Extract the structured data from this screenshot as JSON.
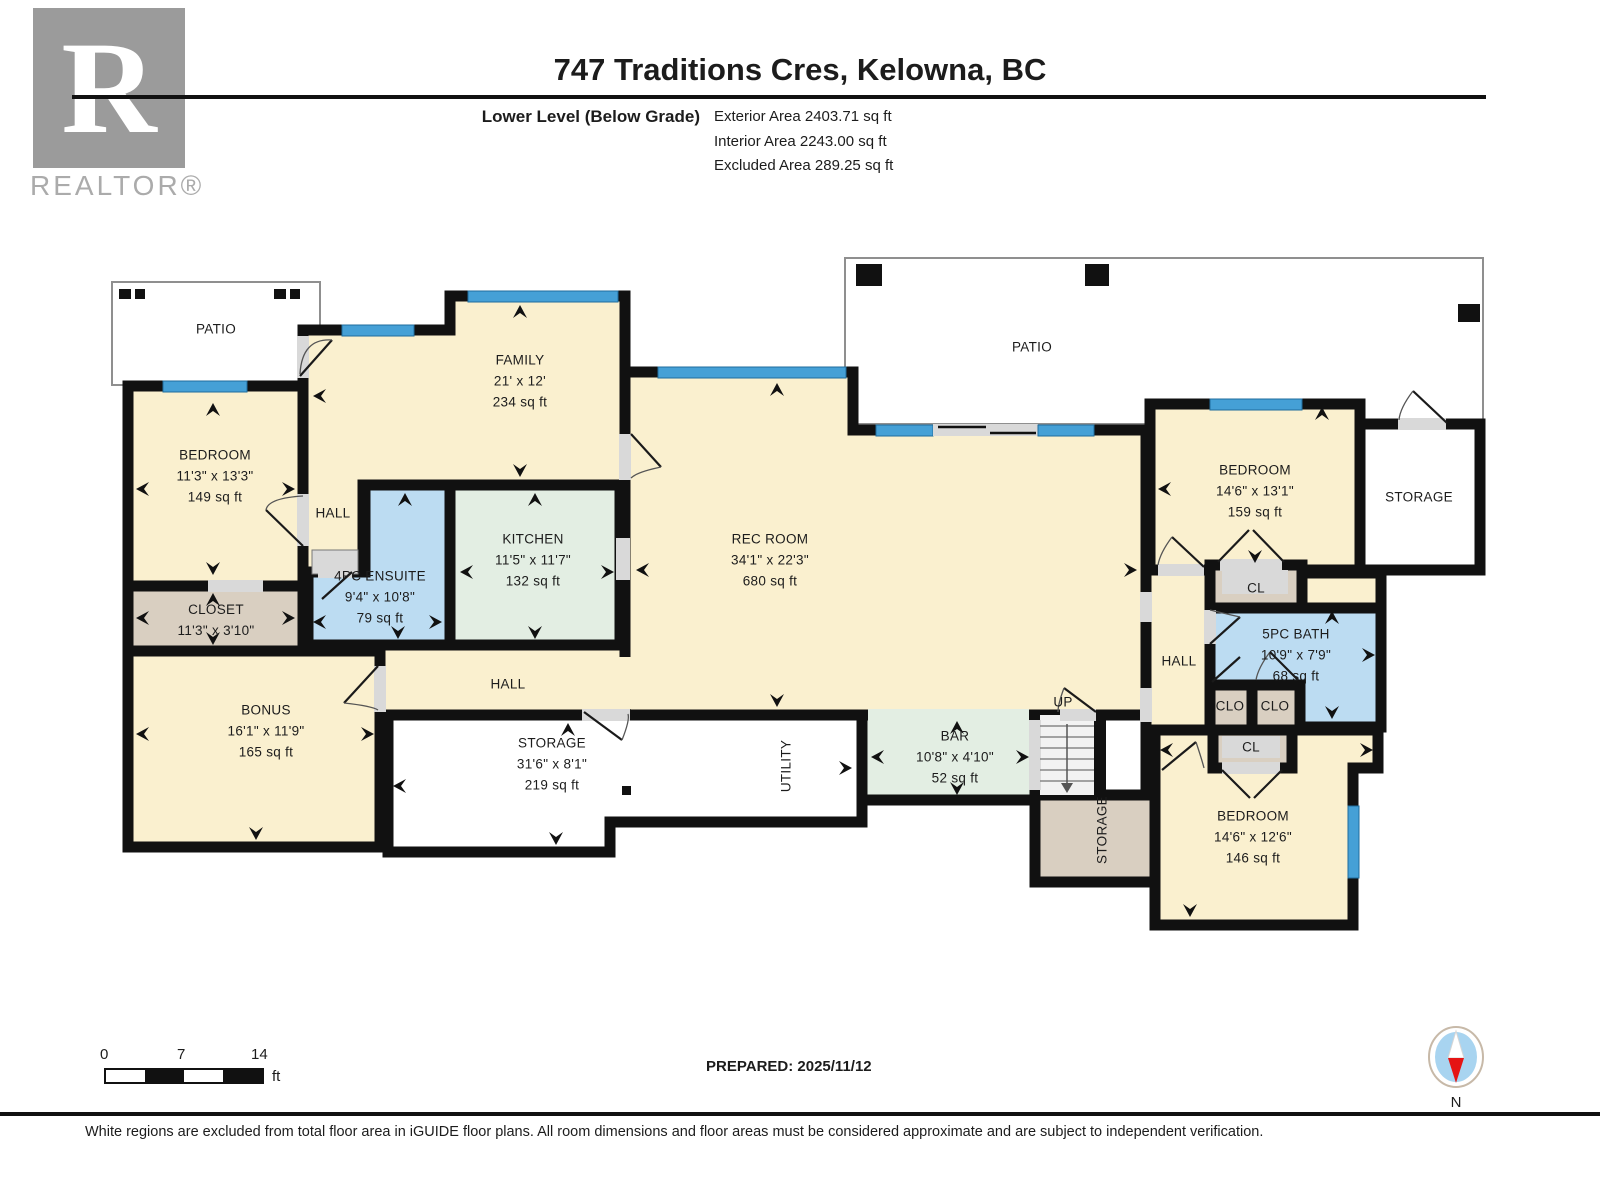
{
  "header": {
    "title": "747 Traditions Cres, Kelowna, BC",
    "level_label": "Lower Level (Below Grade)",
    "exterior_area": "Exterior Area 2403.71 sq ft",
    "interior_area": "Interior Area 2243.00 sq ft",
    "excluded_area": "Excluded Area 289.25 sq ft"
  },
  "branding": {
    "logo_letter": "R",
    "logo_text": "REALTOR®"
  },
  "rooms": {
    "patio_left": {
      "name": "PATIO"
    },
    "bedroom_tl": {
      "name": "BEDROOM",
      "dims": "11'3\" x 13'3\"",
      "area": "149 sq ft"
    },
    "closet_tl": {
      "name": "CLOSET",
      "dims": "11'3\" x 3'10\""
    },
    "hall_tl": {
      "name": "HALL"
    },
    "family": {
      "name": "FAMILY",
      "dims": "21' x 12'",
      "area": "234 sq ft"
    },
    "ensuite": {
      "name": "4PC ENSUITE",
      "dims": "9'4\" x 10'8\"",
      "area": "79 sq ft"
    },
    "kitchen": {
      "name": "KITCHEN",
      "dims": "11'5\" x 11'7\"",
      "area": "132 sq ft"
    },
    "bonus": {
      "name": "BONUS",
      "dims": "16'1\" x 11'9\"",
      "area": "165 sq ft"
    },
    "rec_room": {
      "name": "REC ROOM",
      "dims": "34'1\" x 22'3\"",
      "area": "680 sq ft"
    },
    "hall_center": {
      "name": "HALL"
    },
    "storage_center": {
      "name": "STORAGE",
      "dims": "31'6\" x 8'1\"",
      "area": "219 sq ft"
    },
    "utility": {
      "name": "UTILITY"
    },
    "bar": {
      "name": "BAR",
      "dims": "10'8\" x 4'10\"",
      "area": "52 sq ft"
    },
    "up": {
      "name": "UP"
    },
    "storage_stairs": {
      "name": "STORAGE"
    },
    "patio_right": {
      "name": "PATIO"
    },
    "bedroom_tr": {
      "name": "BEDROOM",
      "dims": "14'6\" x 13'1\"",
      "area": "159 sq ft"
    },
    "storage_tr": {
      "name": "STORAGE"
    },
    "hall_right": {
      "name": "HALL"
    },
    "cl_top": {
      "name": "CL"
    },
    "bath": {
      "name": "5PC BATH",
      "dims": "10'9\" x 7'9\"",
      "area": "68 sq ft"
    },
    "clo_left": {
      "name": "CLO"
    },
    "clo_right": {
      "name": "CLO"
    },
    "cl_bottom": {
      "name": "CL"
    },
    "bedroom_br": {
      "name": "BEDROOM",
      "dims": "14'6\" x 12'6\"",
      "area": "146 sq ft"
    }
  },
  "scale_bar": {
    "start": "0",
    "mid": "7",
    "end": "14",
    "unit": "ft"
  },
  "footer": {
    "prepared": "PREPARED: 2025/11/12",
    "compass_label": "N",
    "disclaimer": "White regions are excluded from total floor area in iGUIDE floor plans. All room dimensions and floor areas must be considered approximate and are subject to independent verification."
  },
  "colors": {
    "wall": "#111111",
    "room_cream": "#FAF0CF",
    "room_blue": "#BCDCF2",
    "room_green": "#E3EEE3",
    "room_tan": "#D9CFC1",
    "window_blue": "#45A0D6",
    "compass_red": "#E51414"
  }
}
